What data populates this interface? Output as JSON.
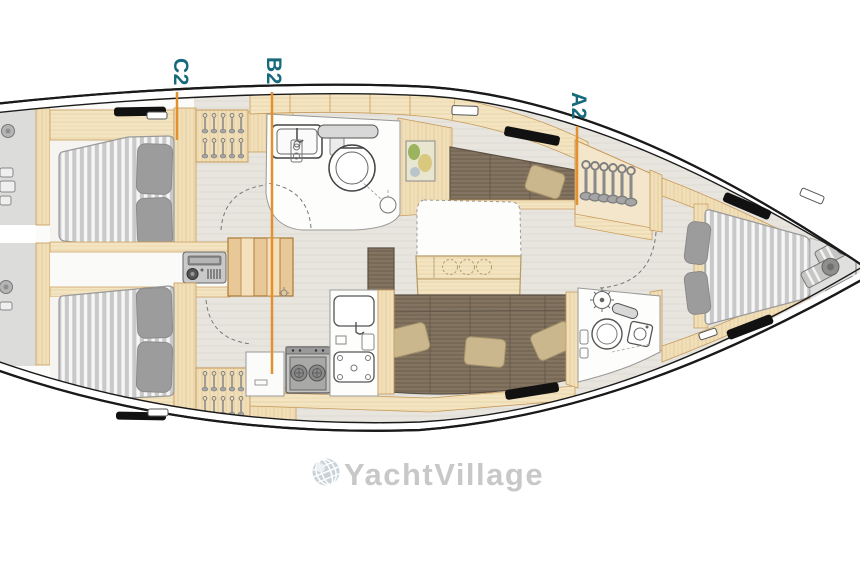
{
  "figure": {
    "type": "yacht-interior-floor-plan",
    "orientation": "bow-right"
  },
  "markers": {
    "c2": {
      "label": "C2"
    },
    "b2": {
      "label": "B2"
    },
    "a2": {
      "label": "A2"
    }
  },
  "watermark": {
    "brand": "YachtVillage",
    "icon": "globe-icon"
  },
  "elements": [
    "aft-cabin-upper-double-berth",
    "aft-cabin-lower-double-berth",
    "wardrobe-hangers-upper",
    "wardrobe-hangers-lower",
    "companionway-steps",
    "radio-unit",
    "aft-head-toilet-sink-shower",
    "nav-chart",
    "salon-table-with-bottle-holders",
    "settee-upper",
    "settee-lower-l-shaped",
    "galley-stove",
    "galley-sink",
    "hanging-locker-forward",
    "forward-head-toilet-sink-shower",
    "v-berth-double",
    "anchor-locker-fenders",
    "stern-platform"
  ],
  "colors": {
    "label_teal": "#17697c",
    "marker_orange": "#e2912e",
    "hull_line": "#1a1a1a",
    "wood_light": "#f1dfba",
    "wood_trim": "#c79a5a",
    "floor_gray": "#e8e5df",
    "upholstery_brown": "#7b6d5a",
    "mattress_gray": "#c9c9c9",
    "pillow_gray": "#9c9c9c",
    "pillow_beige": "#cbb78e",
    "watermark_gray": "#c8c8c8"
  }
}
